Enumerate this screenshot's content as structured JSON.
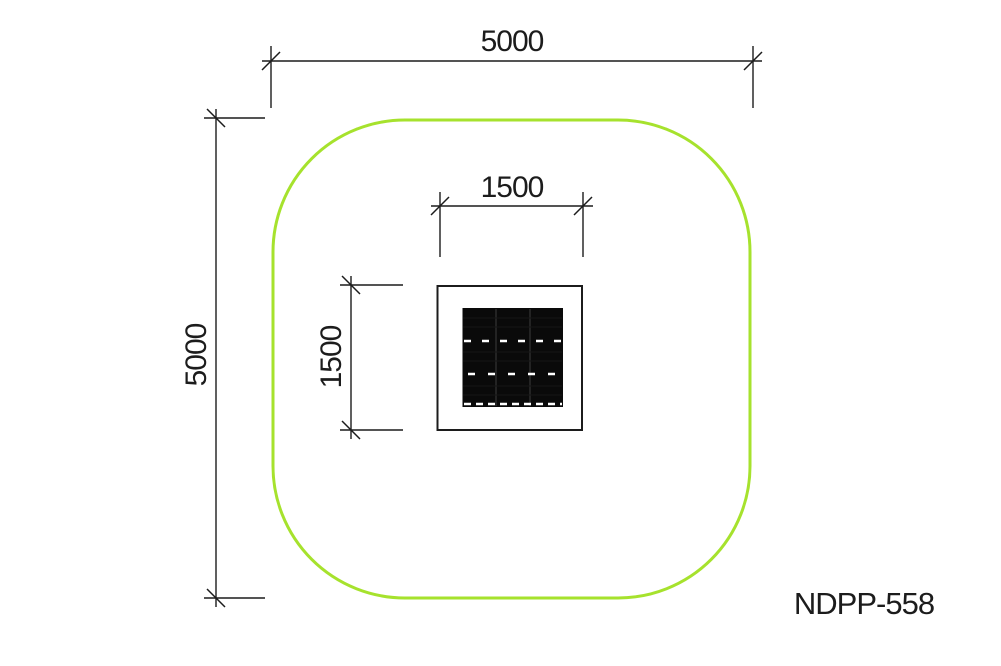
{
  "drawing": {
    "product_code": "NDPP-558",
    "dimensions": {
      "safety_zone_width_mm": "5000",
      "safety_zone_height_mm": "5000",
      "equipment_width_mm": "1500",
      "equipment_height_mm": "1500"
    },
    "colors": {
      "safety_zone": "#a6e22d",
      "line": "#1c1c1c",
      "mat": "#0a0a0a",
      "mat_dash": "#ffffff",
      "background": "#ffffff"
    }
  }
}
